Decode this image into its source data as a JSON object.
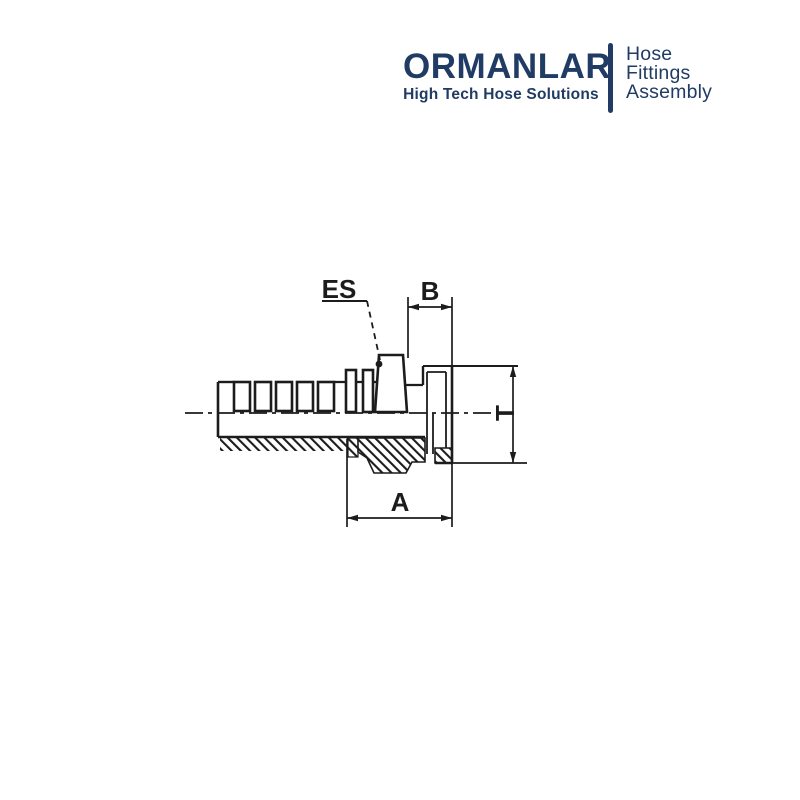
{
  "canvas": {
    "background": "#ffffff"
  },
  "logo": {
    "brand": "ORMANLAR",
    "tagline": "High Tech Hose Solutions",
    "side_text": [
      "Hose",
      "Fittings",
      "Assembly"
    ],
    "brand_color": "#203c64"
  },
  "diagram": {
    "type": "technical-drawing",
    "line_color": "#1c1c1c",
    "labels": {
      "es": "ES",
      "b": "B",
      "t": "T",
      "a": "A"
    }
  }
}
